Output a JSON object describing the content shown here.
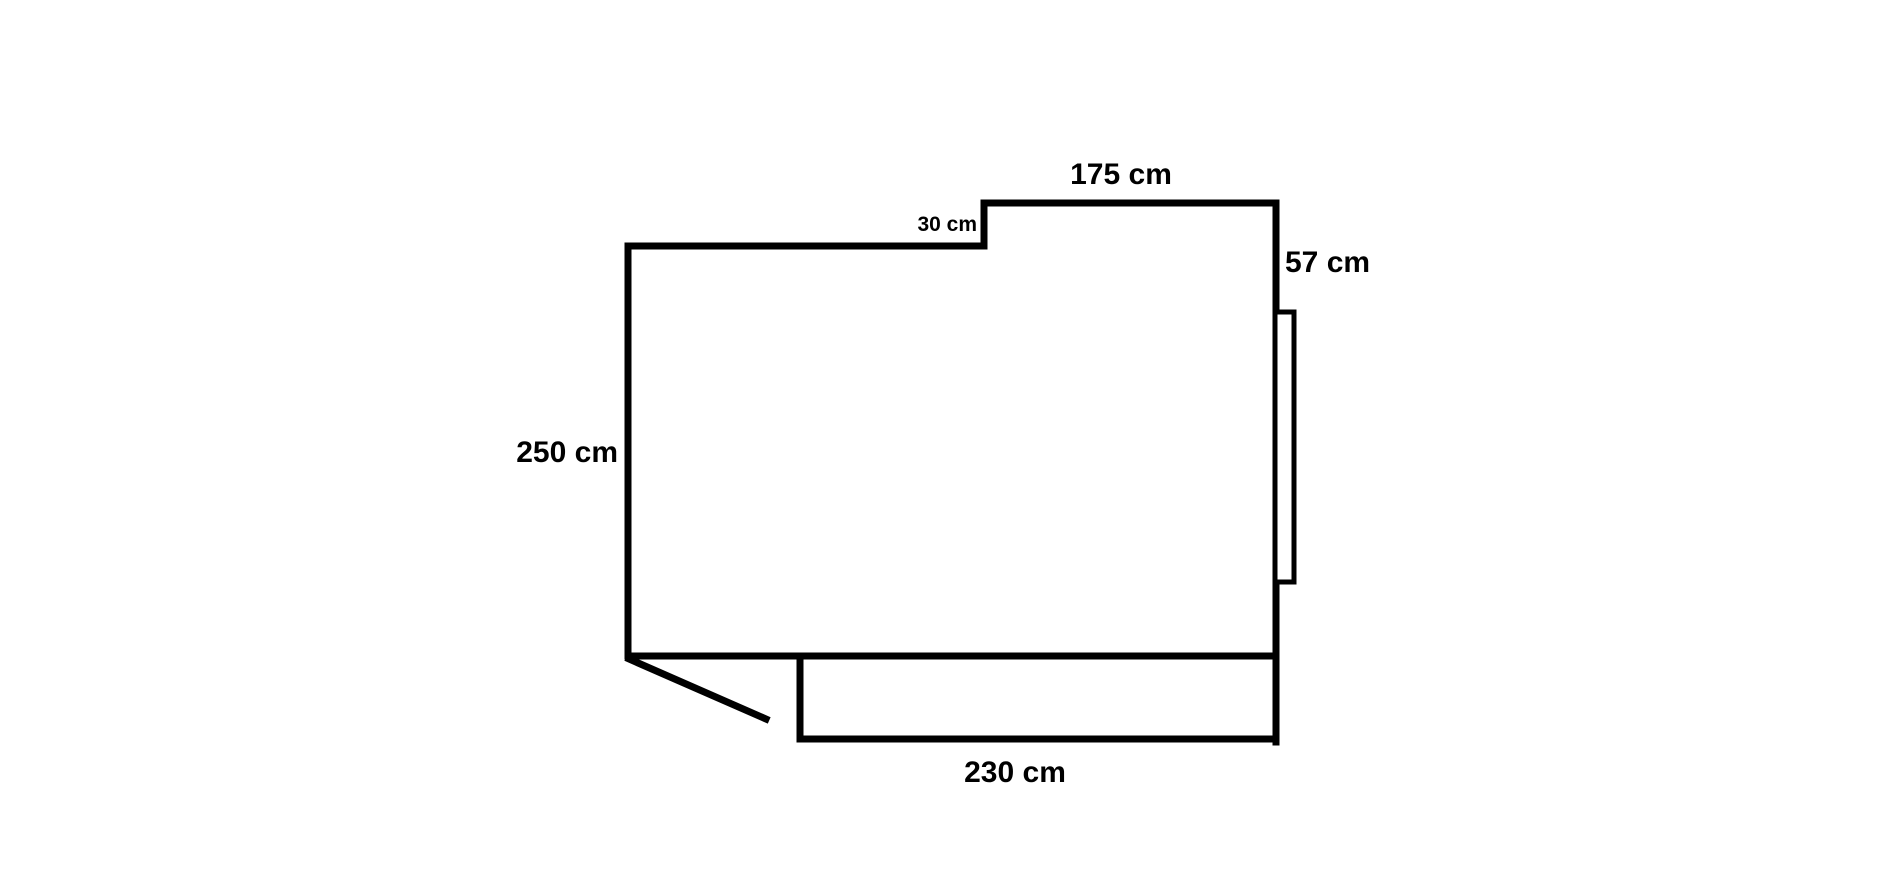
{
  "page": {
    "background": "#ffffff",
    "ink_color": "#000000"
  },
  "floor_plan": {
    "kind": "room-outline-sketch",
    "dimensions": {
      "top_width": {
        "label": "175 cm",
        "value": 175,
        "unit": "cm"
      },
      "step_depth": {
        "label": "30 cm",
        "value": 30,
        "unit": "cm"
      },
      "right_upper": {
        "label": "57 cm",
        "value": 57,
        "unit": "cm"
      },
      "left_height": {
        "label": "250 cm",
        "value": 250,
        "unit": "cm"
      },
      "bottom_width": {
        "label": "230 cm",
        "value": 230,
        "unit": "cm"
      }
    }
  }
}
